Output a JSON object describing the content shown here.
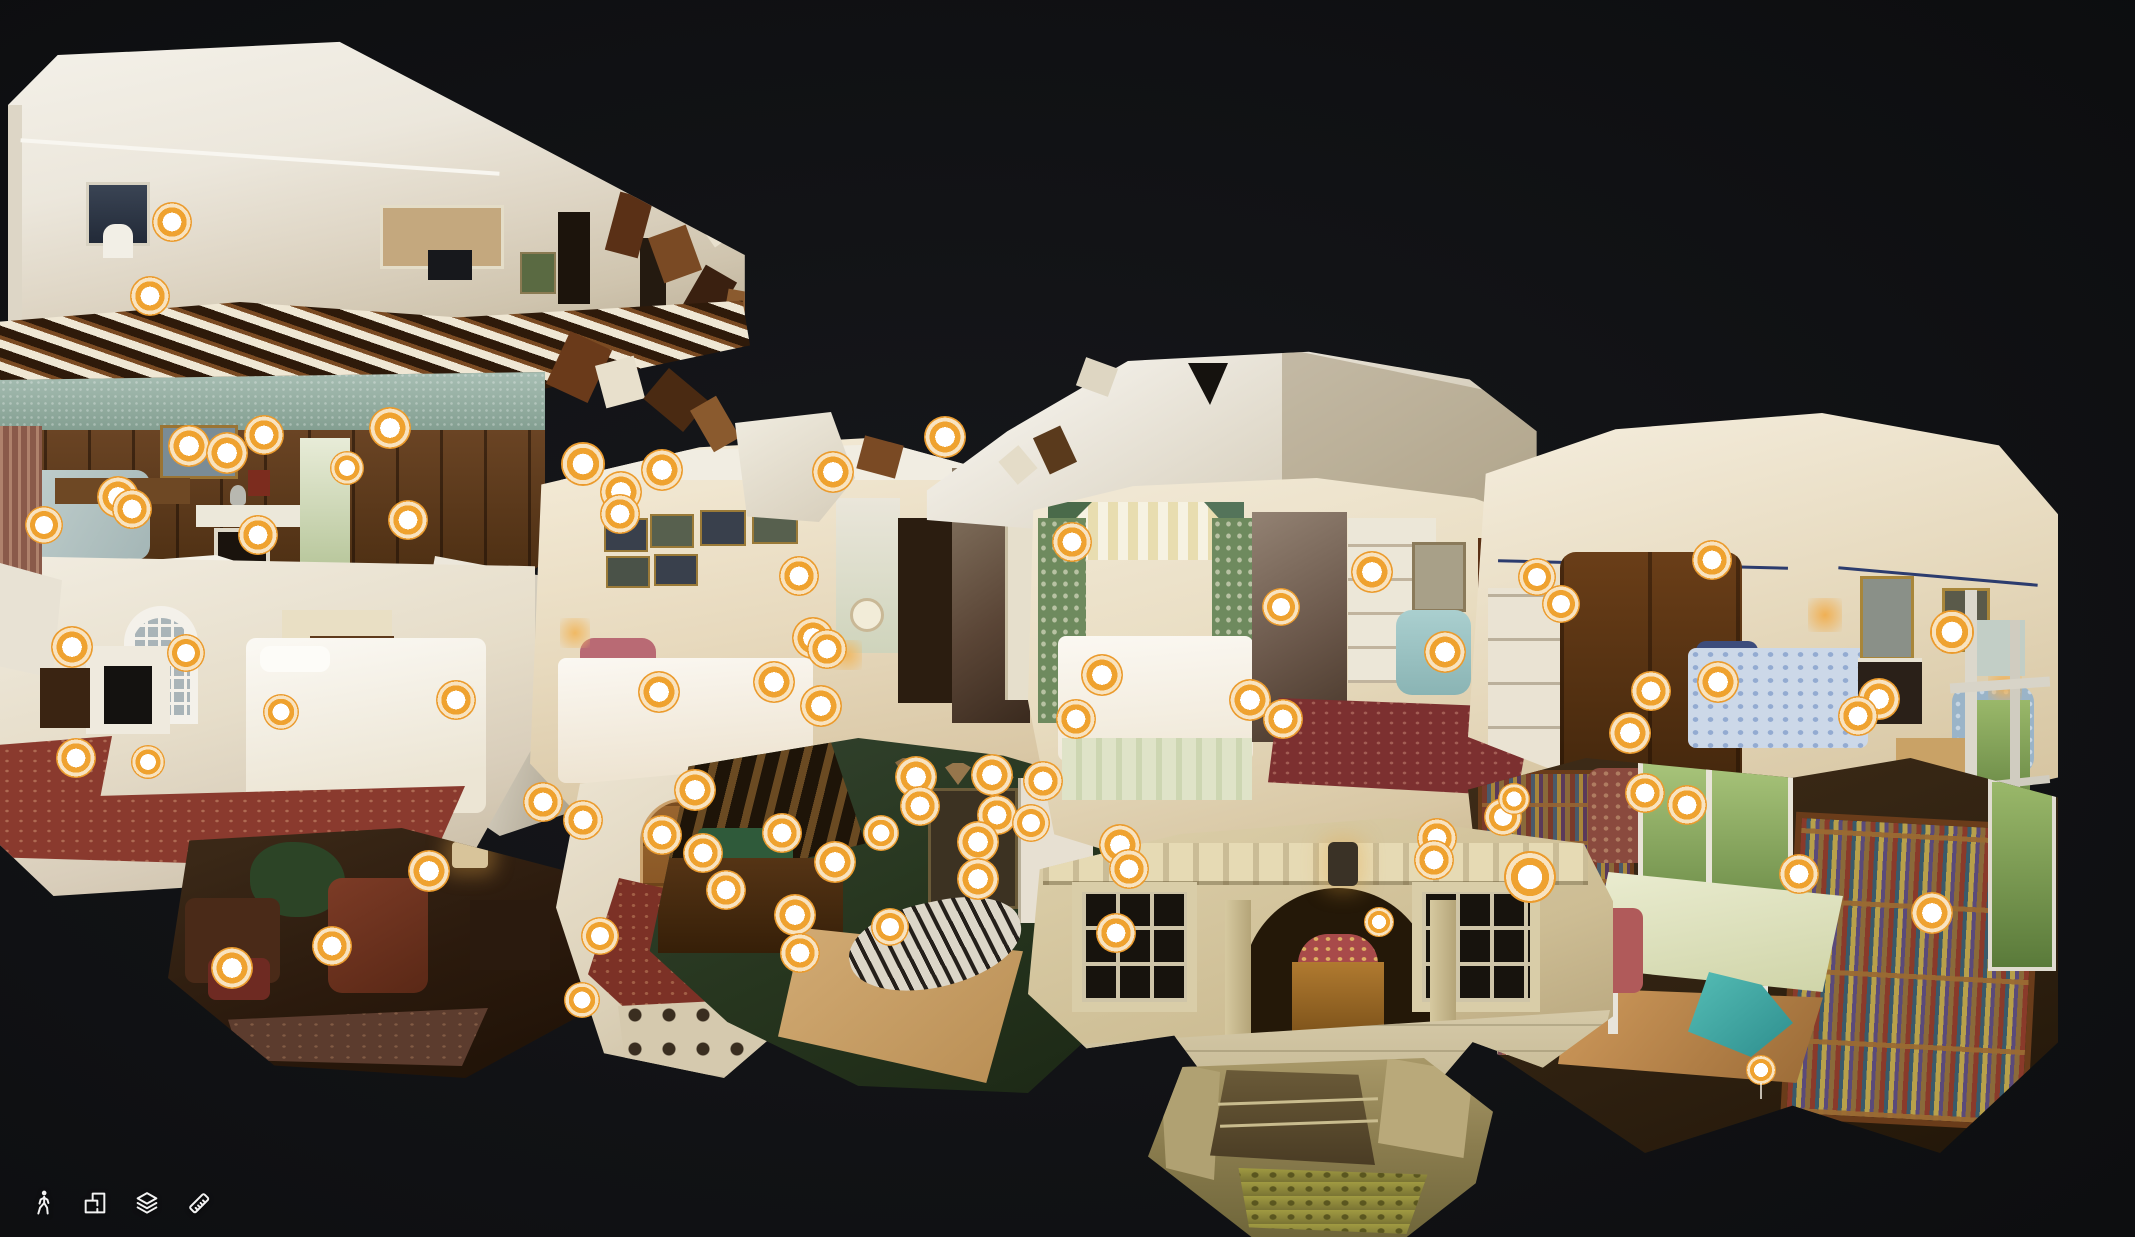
{
  "app": {
    "name": "3D Virtual Tour Viewer",
    "view_mode": "dollhouse"
  },
  "colors": {
    "background": "#101114",
    "marker_ring": "#EB9B2D",
    "marker_center": "#FFFFFF",
    "toolbar_icon": "#F2F2F2"
  },
  "toolbar": {
    "buttons": [
      {
        "id": "walk",
        "icon": "walk-person-icon"
      },
      {
        "id": "floorplan",
        "icon": "floorplan-icon"
      },
      {
        "id": "floors",
        "icon": "layers-icon"
      },
      {
        "id": "measure",
        "icon": "ruler-icon"
      }
    ]
  },
  "scene": {
    "type": "3d-dollhouse-cutaway",
    "markers": [
      [
        172,
        222,
        40
      ],
      [
        150,
        296,
        40
      ],
      [
        189,
        446,
        42
      ],
      [
        227,
        453,
        42
      ],
      [
        264,
        435,
        40
      ],
      [
        390,
        428,
        42
      ],
      [
        347,
        468,
        34
      ],
      [
        408,
        520,
        40
      ],
      [
        258,
        535,
        40
      ],
      [
        118,
        497,
        42
      ],
      [
        132,
        509,
        40
      ],
      [
        44,
        525,
        38
      ],
      [
        72,
        647,
        42
      ],
      [
        76,
        758,
        40
      ],
      [
        148,
        762,
        34
      ],
      [
        186,
        653,
        38
      ],
      [
        281,
        712,
        36
      ],
      [
        456,
        700,
        40
      ],
      [
        429,
        871,
        42
      ],
      [
        332,
        946,
        40
      ],
      [
        232,
        968,
        42
      ],
      [
        662,
        835,
        40
      ],
      [
        703,
        853,
        40
      ],
      [
        726,
        890,
        40
      ],
      [
        600,
        936,
        38
      ],
      [
        582,
        1000,
        36
      ],
      [
        583,
        464,
        44
      ],
      [
        621,
        492,
        42
      ],
      [
        620,
        514,
        40
      ],
      [
        662,
        470,
        42
      ],
      [
        833,
        472,
        42
      ],
      [
        945,
        437,
        42
      ],
      [
        799,
        576,
        40
      ],
      [
        813,
        638,
        42
      ],
      [
        827,
        649,
        40
      ],
      [
        774,
        682,
        42
      ],
      [
        659,
        692,
        42
      ],
      [
        821,
        706,
        42
      ],
      [
        1076,
        719,
        40
      ],
      [
        543,
        802,
        40
      ],
      [
        583,
        820,
        40
      ],
      [
        695,
        790,
        42
      ],
      [
        916,
        777,
        42
      ],
      [
        992,
        775,
        42
      ],
      [
        920,
        806,
        40
      ],
      [
        997,
        815,
        40
      ],
      [
        1043,
        781,
        40
      ],
      [
        782,
        833,
        40
      ],
      [
        835,
        862,
        42
      ],
      [
        881,
        833,
        36
      ],
      [
        978,
        842,
        42
      ],
      [
        978,
        879,
        42
      ],
      [
        795,
        915,
        42
      ],
      [
        800,
        953,
        40
      ],
      [
        890,
        927,
        38
      ],
      [
        1120,
        845,
        42
      ],
      [
        1129,
        869,
        40
      ],
      [
        1116,
        933,
        40
      ],
      [
        1437,
        838,
        40
      ],
      [
        1434,
        860,
        40
      ],
      [
        1379,
        922,
        30
      ],
      [
        1503,
        817,
        38
      ],
      [
        1514,
        799,
        32
      ],
      [
        1530,
        877,
        52
      ],
      [
        1072,
        542,
        40
      ],
      [
        1031,
        823,
        38
      ],
      [
        1102,
        675,
        42
      ],
      [
        1250,
        700,
        42
      ],
      [
        1283,
        719,
        40
      ],
      [
        1281,
        607,
        38
      ],
      [
        1372,
        572,
        42
      ],
      [
        1445,
        652,
        42
      ],
      [
        1537,
        577,
        38
      ],
      [
        1561,
        604,
        38
      ],
      [
        1712,
        560,
        40
      ],
      [
        1718,
        682,
        42
      ],
      [
        1651,
        691,
        40
      ],
      [
        1630,
        733,
        42
      ],
      [
        1879,
        699,
        42
      ],
      [
        1858,
        716,
        40
      ],
      [
        1952,
        632,
        44
      ],
      [
        1645,
        793,
        40
      ],
      [
        1687,
        805,
        40
      ],
      [
        1799,
        874,
        40
      ],
      [
        1932,
        913,
        42
      ],
      [
        1761,
        1070,
        30,
        1
      ]
    ]
  }
}
